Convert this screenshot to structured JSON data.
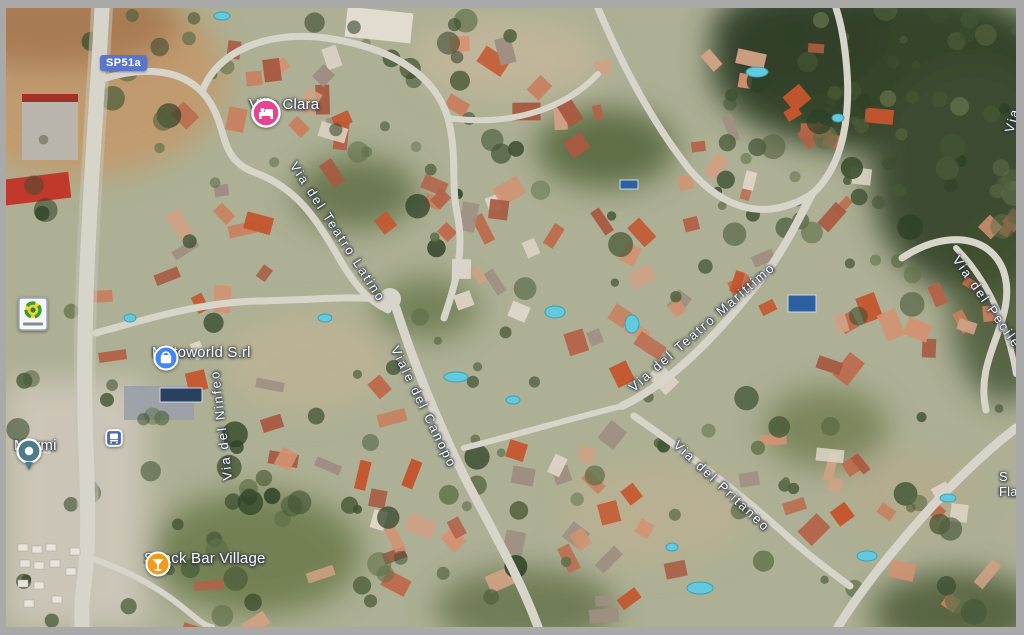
{
  "window": {
    "frame_color": "#a9a9a9",
    "view_type": "satellite-map"
  },
  "map": {
    "road_badge": {
      "label": "SP51a",
      "color": "#5b76c8"
    },
    "street_labels": [
      {
        "text": "Via del Teatro Latino"
      },
      {
        "text": "Via del Ninfeo"
      },
      {
        "text": "Viale del Canopo"
      },
      {
        "text": "Via del Teatro Marittimo"
      },
      {
        "text": "Via del Pritaneo"
      },
      {
        "text": "Via del Pecile"
      },
      {
        "text": "Via"
      }
    ],
    "pois": [
      {
        "name": "Villa Clara",
        "icon": "lodging-icon",
        "icon_color": "#e5458f"
      },
      {
        "name": "Motoworld S.rl",
        "icon": "shopping-icon",
        "icon_color": "#4285f4"
      },
      {
        "name": "Marmi",
        "icon": "place-pin-icon",
        "icon_color": "#4d7c88"
      },
      {
        "name": "Snack Bar Village",
        "icon": "bar-icon",
        "icon_color": "#f09b20"
      },
      {
        "name": "S",
        "name_line2": "Fla",
        "icon": "truncated-edge-label"
      }
    ],
    "transit": {
      "bus_stop": {
        "icon": "bus-icon",
        "color": "#4a69b0"
      }
    },
    "business_logo_marker": {
      "icon": "green-emblem-logo-icon"
    }
  }
}
